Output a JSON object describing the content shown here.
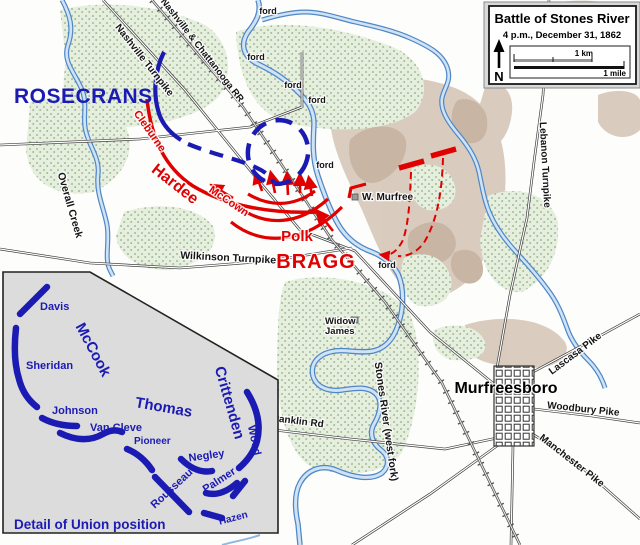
{
  "legend": {
    "title": "Battle of Stones River",
    "subtitle": "4 p.m., December 31, 1862",
    "north": "N",
    "scale_km": "1 km",
    "scale_mile": "1 mile"
  },
  "armies": {
    "union_commander": "ROSECRANS",
    "confederate_commander": "BRAGG",
    "confederate_units": {
      "hardee": "Hardee",
      "cleburne": "Cleburne",
      "mccown": "McCown",
      "polk": "Polk"
    }
  },
  "places": {
    "town": "Murfreesboro",
    "w_murfree": "W. Murfree",
    "widow_james_line1": "Widow",
    "widow_james_line2": "James"
  },
  "roads": {
    "nashville_turnpike": "Nashville Turnpike",
    "nashville_chattanooga_rr": "Nashville & Chattanooga RR",
    "wilkinson_turnpike": "Wilkinson Turnpike",
    "franklin_rd": "Franklin Rd",
    "lebanon_turnpike": "Lebanon Turnpike",
    "lascasa_pike": "Lascasa Pike",
    "woodbury_pike": "Woodbury Pike",
    "manchester_pike": "Manchester Pike"
  },
  "waterways": {
    "overall_creek": "Overall Creek",
    "stones_river": "Stones River (west fork)"
  },
  "fords": [
    "ford",
    "ford",
    "ford",
    "ford",
    "ford",
    "ford"
  ],
  "inset": {
    "caption": "Detail of Union position",
    "corps": {
      "mccook": "McCook",
      "thomas": "Thomas",
      "crittenden": "Crittenden"
    },
    "units": {
      "davis": "Davis",
      "sheridan": "Sheridan",
      "johnson": "Johnson",
      "van_cleve": "Van Cleve",
      "pioneer": "Pioneer",
      "negley": "Negley",
      "rousseau": "Rousseau",
      "palmer": "Palmer",
      "hazen": "Hazen",
      "wood": "Wood"
    }
  },
  "colors": {
    "union_blue": "#1b1bb4",
    "confederate_red": "#e00000",
    "river_blue": "#4f86c6",
    "forest_green": "#e6eede",
    "terrain_tan": "#d8cabc"
  }
}
